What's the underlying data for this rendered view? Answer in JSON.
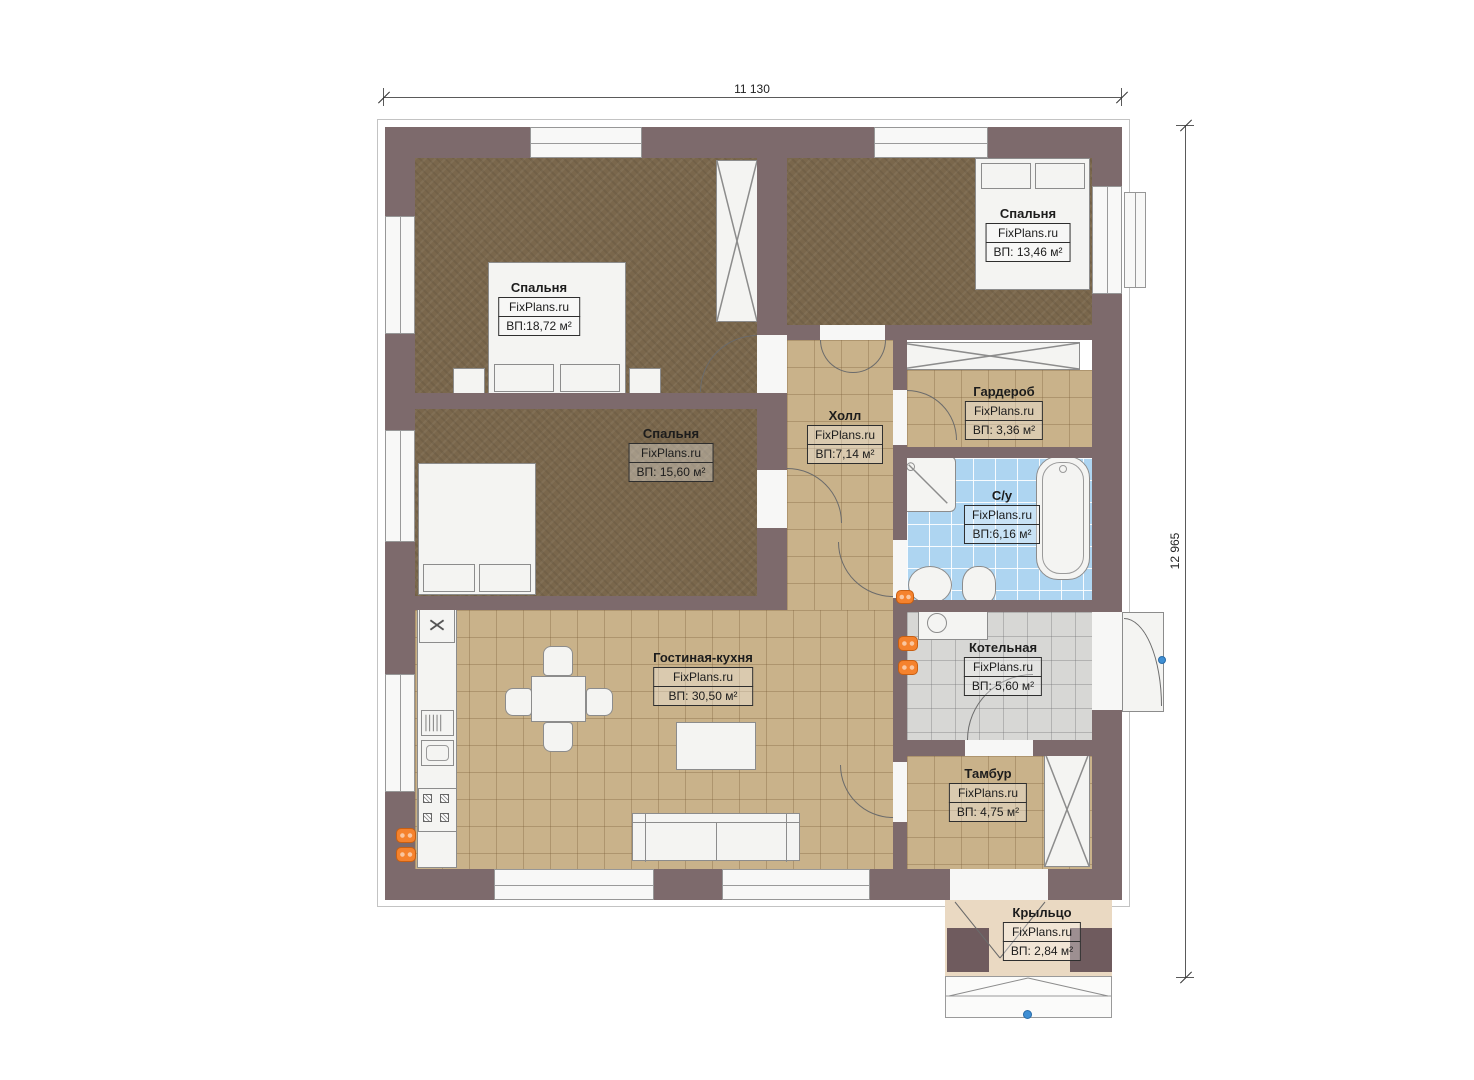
{
  "plan": {
    "title": "Single-storey house floor plan",
    "brand": "FixPlans.ru",
    "dimensions": {
      "width_label": "11 130",
      "height_label": "12 965"
    },
    "rooms": [
      {
        "id": "bedroom-1",
        "name": "Спальня",
        "brand": "FixPlans.ru",
        "area": "ВП:18,72 м²"
      },
      {
        "id": "bedroom-2",
        "name": "Спальня",
        "brand": "FixPlans.ru",
        "area": "ВП: 13,46 м²"
      },
      {
        "id": "bedroom-3",
        "name": "Спальня",
        "brand": "FixPlans.ru",
        "area": "ВП: 15,60 м²"
      },
      {
        "id": "hall",
        "name": "Холл",
        "brand": "FixPlans.ru",
        "area": "ВП:7,14 м²"
      },
      {
        "id": "wardrobe-room",
        "name": "Гардероб",
        "brand": "FixPlans.ru",
        "area": "ВП: 3,36 м²"
      },
      {
        "id": "bathroom",
        "name": "С/у",
        "brand": "FixPlans.ru",
        "area": "ВП:6,16 м²"
      },
      {
        "id": "boiler-room",
        "name": "Котельная",
        "brand": "FixPlans.ru",
        "area": "ВП: 5,60 м²"
      },
      {
        "id": "living-kitchen",
        "name": "Гостиная-кухня",
        "brand": "FixPlans.ru",
        "area": "ВП: 30,50 м²"
      },
      {
        "id": "vestibule",
        "name": "Тамбур",
        "brand": "FixPlans.ru",
        "area": "ВП: 4,75 м²"
      },
      {
        "id": "porch",
        "name": "Крыльцо",
        "brand": "FixPlans.ru",
        "area": "ВП: 2,84 м²"
      }
    ],
    "colors": {
      "wall": "#7d6a6c",
      "carpet_brown": "#7a674c",
      "tile_tan": "#c9b28a",
      "tile_blue": "#aed5f1",
      "tile_gray": "#d7d7d5",
      "porch_floor": "#ead9c2",
      "radiator_orange": "#f5822d",
      "marker_blue": "#3f8fd4"
    }
  }
}
